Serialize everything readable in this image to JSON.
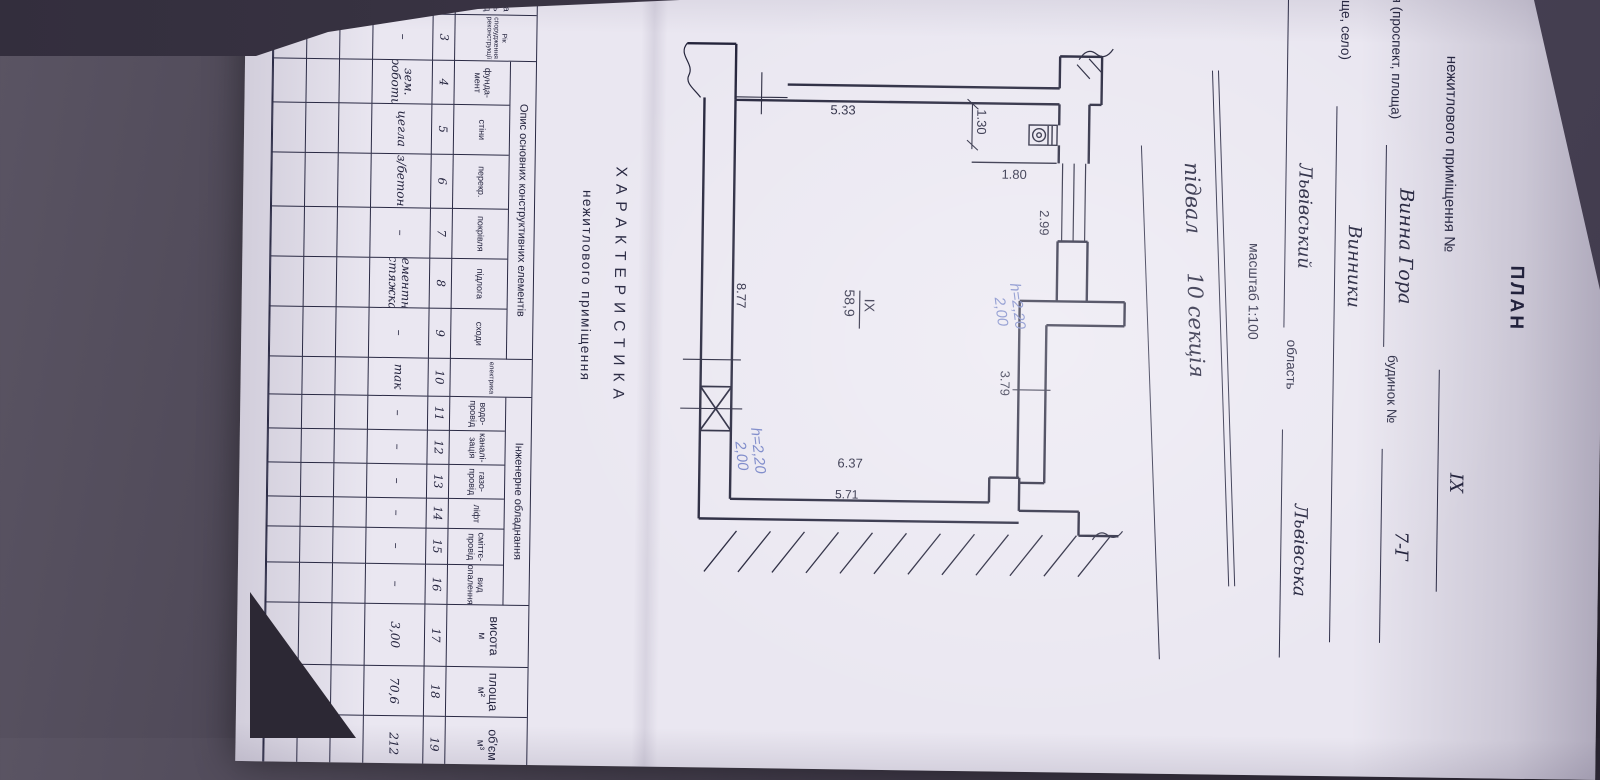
{
  "colors": {
    "paper": "#eae7f1",
    "ink": "#22223c",
    "plan_lines": "#23233a",
    "handwriting_blue": "#7280c5",
    "background": "#3c3646"
  },
  "header": {
    "title": "ПЛАН",
    "premises_label": "нежитлового приміщення №",
    "premises_no": "ІХ",
    "street_label": "вулиця (проспект, площа)",
    "street_value": "Винна Гора",
    "building_label": "будинок №",
    "building_no": "7-Г",
    "settlement_label": "(селище, село)",
    "settlement_value": "Винники",
    "district_label": "район",
    "district_value": "Львівський",
    "region_label": "область",
    "region_value": "Львівська",
    "scale": "масштаб 1:100",
    "section_l1": "підвал",
    "section_l2": "10 секція"
  },
  "plan": {
    "room_no": "ІХ",
    "room_area": "58,9",
    "dims": {
      "closet_width": "1.30",
      "closet_height": "1.80",
      "opening_width": "2.99",
      "recess_width": "3.79",
      "left_height": "5.33",
      "right_height_inner": "6.37",
      "right_height_outer": "5.71",
      "bottom_width": "8.77"
    },
    "note_h_upper": "h=2,20",
    "note_h_lower": "2,00"
  },
  "characteristics": {
    "title": "ХАРАКТЕРИСТИКА",
    "subtitle": "нежитлового приміщення"
  },
  "table": {
    "group1": "Опис основних конструктивних елементів",
    "group2": "Інженерне обладнання",
    "columns": [
      {
        "id": "name",
        "num": "2",
        "header": "Назва\nбудівель\nспоруд",
        "value": "нежитлове\nприміщення",
        "w": 100,
        "tall": true,
        "right": true
      },
      {
        "id": "year",
        "num": "3",
        "header": "Рік\nспорудження\nреконструкції",
        "value": "–",
        "w": 46,
        "tall": true,
        "small": true
      },
      {
        "id": "foundation",
        "num": "4",
        "header": "фунда-\nмент",
        "value": "зем.\nроботи",
        "w": 44,
        "group": 1
      },
      {
        "id": "walls",
        "num": "5",
        "header": "стіни",
        "value": "цегла",
        "w": 50,
        "group": 1
      },
      {
        "id": "ceiling",
        "num": "6",
        "header": "перекр.",
        "value": "з/бетон",
        "w": 54,
        "group": 1
      },
      {
        "id": "roof",
        "num": "7",
        "header": "покрівля",
        "value": "–",
        "w": 50,
        "group": 1
      },
      {
        "id": "floor",
        "num": "8",
        "header": "підлога",
        "value": "цементна\nстяжка",
        "w": 50,
        "group": 1
      },
      {
        "id": "stairs",
        "num": "9",
        "header": "сходи",
        "value": "–",
        "w": 50,
        "group": 1
      },
      {
        "id": "electricity",
        "num": "10",
        "header": "електрика",
        "value": "так",
        "w": 38,
        "tall": true,
        "small": true
      },
      {
        "id": "water",
        "num": "11",
        "header": "водо-\nпровід",
        "value": "–",
        "w": 34,
        "group": 2
      },
      {
        "id": "sewerage",
        "num": "12",
        "header": "каналі-\nзація",
        "value": "–",
        "w": 34,
        "group": 2
      },
      {
        "id": "gas",
        "num": "13",
        "header": "газо-\nпровід",
        "value": "–",
        "w": 34,
        "group": 2
      },
      {
        "id": "lift",
        "num": "14",
        "header": "ліфт",
        "value": "–",
        "w": 30,
        "group": 2
      },
      {
        "id": "chute",
        "num": "15",
        "header": "сміттє-\nпровід",
        "value": "–",
        "w": 36,
        "group": 2
      },
      {
        "id": "heating",
        "num": "16",
        "header": "вид\nопалення",
        "value": "–",
        "w": 40,
        "group": 2
      },
      {
        "id": "height",
        "num": "17",
        "header": "висота\nм",
        "value": "3,00",
        "w": 62,
        "tall": true,
        "big": true
      },
      {
        "id": "area",
        "num": "18",
        "header": "площа\nм²",
        "value": "70,6",
        "w": 50,
        "tall": true,
        "big": true
      },
      {
        "id": "volume",
        "num": "19",
        "header": "об'єм\nм³",
        "value": "212",
        "w": 56,
        "tall": true,
        "big": true
      }
    ],
    "empty_rows": 3
  }
}
